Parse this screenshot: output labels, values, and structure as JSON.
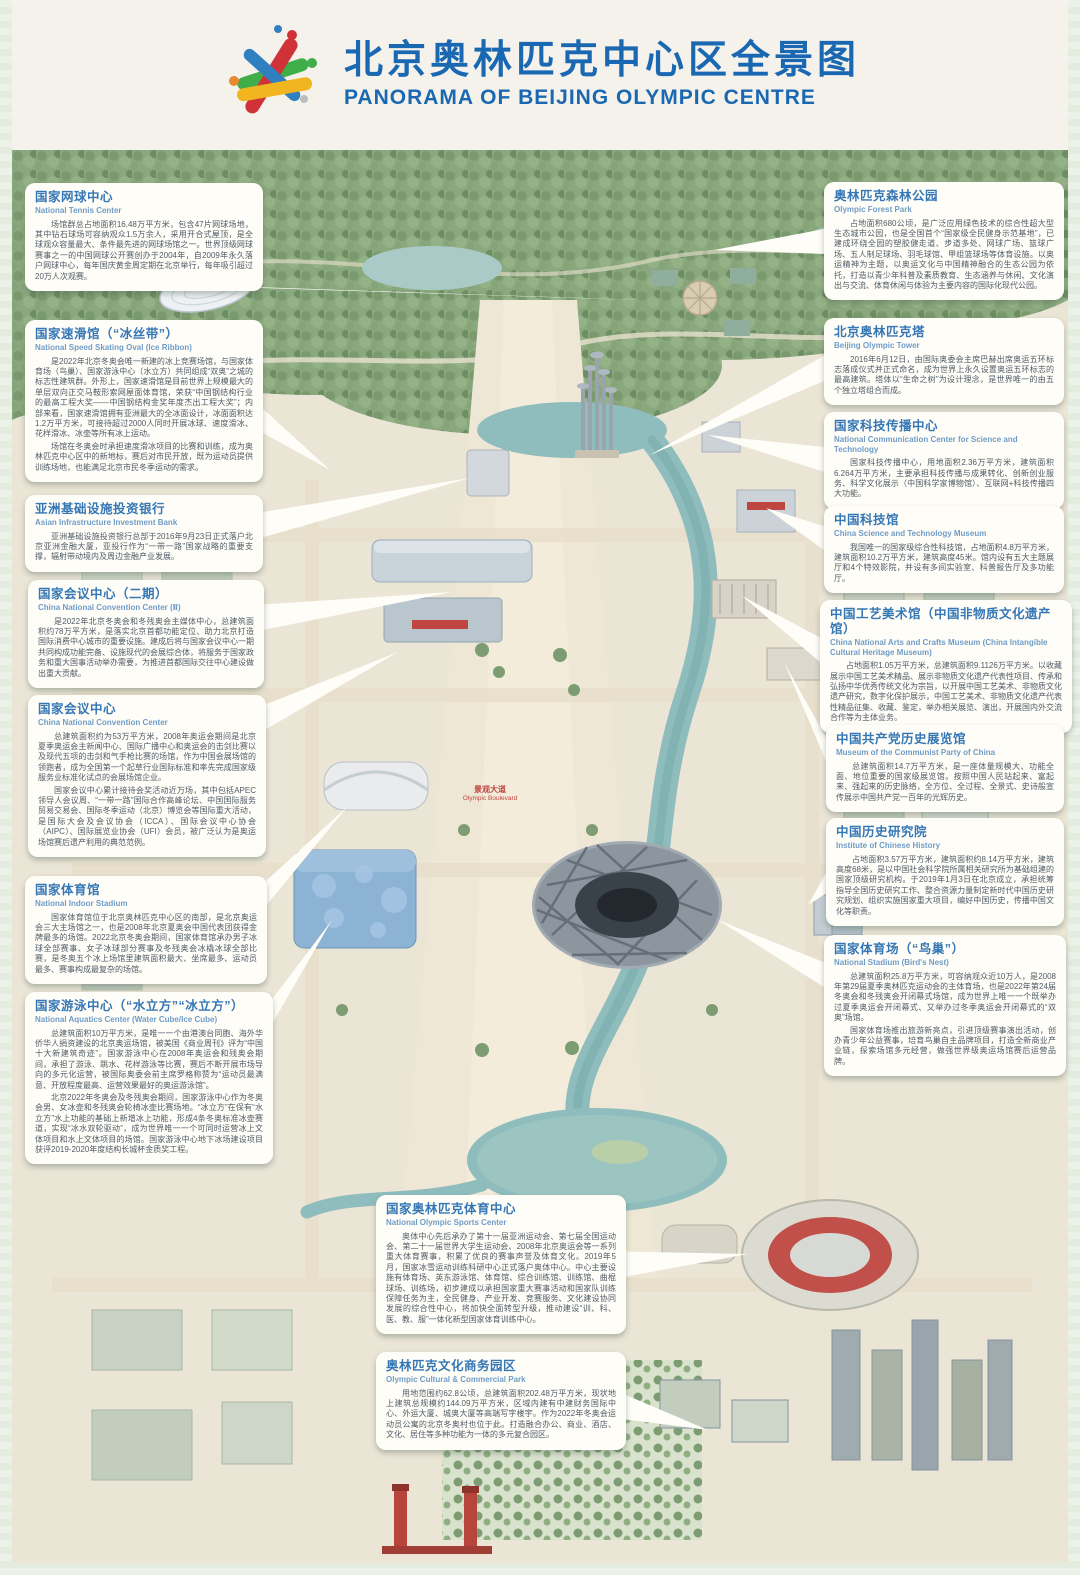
{
  "header": {
    "title_zh": "北京奥林匹克中心区全景图",
    "title_en": "PANORAMA OF BEIJING OLYMPIC CENTRE"
  },
  "colors": {
    "title_blue": "#1a68b2",
    "callout_title_blue": "#3577b5",
    "body_text": "#4f5b66",
    "leader_white": "#fffdf8",
    "river_teal": "#8fbdbd",
    "forest_green": "#8aa87e",
    "sign_red": "#bf4540"
  },
  "map": {
    "boulevard_label_zh": "景观大道",
    "boulevard_label_en": "Olympic Boulevard"
  },
  "callouts": [
    {
      "id": "national-tennis-center",
      "title_zh": "国家网球中心",
      "title_en": "National Tennis Center",
      "body": [
        "场馆群总占地面积16.48万平方米，包含47片网球场地，其中钻石球场可容纳观众1.5万余人，采用开合式屋顶，是全球观众容量最大、条件最先进的网球场馆之一。世界顶级网球赛事之一的中国网球公开赛创办于2004年，自2009年永久落户网球中心，每年国庆黄金周定期在北京举行，每年吸引超过20万人次观赛。"
      ],
      "pos": {
        "left": 25,
        "top": 183,
        "width": 238
      },
      "tail": {
        "side": "bottom",
        "f": 0.78,
        "tx": 700,
        "ty": 302
      }
    },
    {
      "id": "national-speed-skating-oval",
      "title_zh": "国家速滑馆（“冰丝带”）",
      "title_en": "National Speed Skating Oval (Ice Ribbon)",
      "body": [
        "是2022年北京冬奥会唯一新建的冰上竞赛场馆，与国家体育场（鸟巢）、国家游泳中心（水立方）共同组成“双奥”之城的标志性建筑群。外形上，国家速滑馆是目前世界上规模最大的单层双向正交马鞍形索网屋面体育馆，荣获“中国钢结构行业的最高工程大奖——中国钢结构金奖年度杰出工程大奖”；内部来看，国家速滑馆拥有亚洲最大的全冰面设计，冰面面积达1.2万平方米，可接待超过2000人同时开展冰球、速度滑冰、花样滑冰、冰壶等所有冰上运动。",
        "场馆在冬奥会时承担速度滑冰项目的比赛和训练，成为奥林匹克中心区中的新地标，赛后对市民开放，既为运动员提供训练场地，也能满足北京市民冬季运动的需求。"
      ],
      "pos": {
        "left": 25,
        "top": 320,
        "width": 238
      },
      "tail": {
        "side": "right",
        "f": 0.6,
        "tx": 330,
        "ty": 470
      }
    },
    {
      "id": "asian-infrastructure-investment-bank",
      "title_zh": "亚洲基础设施投资银行",
      "title_en": "Asian Infrastructure Investment Bank",
      "body": [
        "亚洲基础设施投资银行总部于2016年9月23日正式落户北京亚洲金融大厦，亚投行作为“一带一路”国家战略的重要支撑，辐射带动境内及周边金融产业发展。"
      ],
      "pos": {
        "left": 25,
        "top": 495,
        "width": 238
      },
      "tail": {
        "side": "right",
        "f": 0.4,
        "tx": 470,
        "ty": 478
      }
    },
    {
      "id": "china-national-convention-center-2",
      "title_zh": "国家会议中心（二期）",
      "title_en": "China National Convention Center (Ⅱ)",
      "body": [
        "是2022年北京冬奥会和冬残奥会主媒体中心，总建筑面积约78万平方米，是落实北京首都功能定位、助力北京打造国际消费中心城市的重要设施。建成后将与国家会议中心一期共同构成功能完备、设施现代的会展综合体，将服务于国家政务和重大国事活动举办需要，为推进首都国际交往中心建设做出重大贡献。"
      ],
      "pos": {
        "left": 28,
        "top": 580,
        "width": 236
      },
      "tail": {
        "side": "right",
        "f": 0.35,
        "tx": 452,
        "ty": 592
      }
    },
    {
      "id": "china-national-convention-center",
      "title_zh": "国家会议中心",
      "title_en": "China National Convention Center",
      "body": [
        "总建筑面积约为53万平方米，2008年奥运会期间是北京夏季奥运会主新闻中心、国际广播中心和奥运会的击剑比赛以及现代五项的击剑和气手枪比赛的场馆，作为中国会展场馆的领跑者，成为全国第一个起草行业国际标准和率先完成国家级服务业标准化试点的会展场馆企业。",
        "国家会议中心累计接待会奖活动近万场，其中包括APEC领导人会议周、“一带一路”国际合作高峰论坛、中国国际服务贸易交易会、国际冬季运动（北京）博览会等国际重大活动，是国际大会及会议协会（ICCA）、国际会议中心协会（AIPC）、国际展览业协会（UFI）会员，被广泛认为是奥运场馆赛后遗产利用的典范范例。"
      ],
      "pos": {
        "left": 28,
        "top": 695,
        "width": 238
      },
      "tail": {
        "side": "right",
        "f": 0.15,
        "tx": 398,
        "ty": 652
      }
    },
    {
      "id": "national-indoor-stadium",
      "title_zh": "国家体育馆",
      "title_en": "National Indoor Stadium",
      "body": [
        "国家体育馆位于北京奥林匹克中心区的南部，是北京奥运会三大主场馆之一，也是2008年北京夏奥会中国代表团获得金牌最多的场馆。2022北京冬奥会期间，国家体育馆承办男子冰球全部赛事、女子冰球部分赛事及冬残奥会冰橇冰球全部比赛，是冬奥五个冰上场馆里建筑面积最大、坐席最多、运动员最多、赛事构成最复杂的场馆。"
      ],
      "pos": {
        "left": 25,
        "top": 876,
        "width": 242
      },
      "tail": {
        "side": "right",
        "f": 0.2,
        "tx": 348,
        "ty": 806
      }
    },
    {
      "id": "national-aquatics-center",
      "title_zh": "国家游泳中心（“水立方”“冰立方”）",
      "title_en": "National Aquatics Center (Water Cube/Ice Cube)",
      "body": [
        "总建筑面积10万平方米，是唯一一个由港澳台同胞、海外华侨华人捐资建设的北京奥运场馆，被美国《商业周刊》评为“中国十大新建筑奇迹”。国家游泳中心在2008年奥运会和残奥会期间，承担了游泳、跳水、花样游泳等比赛，赛后不断开展市场导向的多元化运营，被国际奥委会前主席罗格称赞为“运动员最满意、开放程度最高、运营效果最好的奥运游泳馆”。",
        "北京2022年冬奥会及冬残奥会期间，国家游泳中心作为冬奥会男、女冰壶和冬残奥会轮椅冰壶比赛场地。“冰立方”在保有“水立方”水上功能的基础上新增冰上功能，形成4条冬奥标准冰壶赛道，实现“冰水双轮驱动”，成为世界唯一一个可同时运营冰上文体项目和水上文体项目的场馆。国家游泳中心地下冰场建设项目获评2019-2020年度结构长城杯金质奖工程。"
      ],
      "pos": {
        "left": 25,
        "top": 992,
        "width": 248
      },
      "tail": {
        "side": "right",
        "f": 0.15,
        "tx": 332,
        "ty": 920
      }
    },
    {
      "id": "olympic-forest-park",
      "title_zh": "奥林匹克森林公园",
      "title_en": "Olympic Forest Park",
      "body": [
        "占地面积680公顷，是广泛应用绿色技术的综合性超大型生态城市公园，也是全国首个“国家级全民健身示范基地”，已建成环绕全园的塑胶健走道、步道多处、网球广场、篮球广场、五人制足球场、羽毛球馆、甲组篮球场等体育设施。以奥运精神为主题，以奥运文化与中国精神融合的生态公园为依托，打造以青少年科普及素质教育、生态涵养与休闲、文化演出与交流、体育休闲与体验为主要内容的国际化现代公园。"
      ],
      "pos": {
        "left": 824,
        "top": 182,
        "width": 240
      },
      "tail": {
        "side": "left",
        "f": 0.5,
        "tx": 714,
        "ty": 250
      }
    },
    {
      "id": "beijing-olympic-tower",
      "title_zh": "北京奥林匹克塔",
      "title_en": "Beijing Olympic Tower",
      "body": [
        "2016年6月12日，由国际奥委会主席巴赫出席奥运五环标志落成仪式并正式命名，成为世界上永久设置奥运五环标志的最高建筑。塔体以“生命之树”为设计理念，是世界唯一的由五个独立塔组合而成。"
      ],
      "pos": {
        "left": 824,
        "top": 318,
        "width": 240
      },
      "tail": {
        "side": "left",
        "f": 0.55,
        "tx": 650,
        "ty": 455
      }
    },
    {
      "id": "national-communication-center-for-science-and-technology",
      "title_zh": "国家科技传播中心",
      "title_en": "National Communication Center for Science and Technology",
      "body": [
        "国家科技传播中心，用地面积2.36万平方米，建筑面积6.264万平方米，主要承担科技传播与成果转化、创新创业服务、科学文化展示（中国科学家博物馆）、互联网+科技传播四大功能。"
      ],
      "pos": {
        "left": 824,
        "top": 412,
        "width": 240
      },
      "tail": {
        "side": "left",
        "f": 0.5,
        "tx": 708,
        "ty": 435
      }
    },
    {
      "id": "china-science-and-technology-museum",
      "title_zh": "中国科技馆",
      "title_en": "China Science and Technology Museum",
      "body": [
        "我国唯一的国家级综合性科技馆，占地面积4.8万平方米，建筑面积10.2万平方米，建筑高度45米。馆内设有五大主题展厅和4个特效影院，并设有多间实验室、科普报告厅及多功能厅。"
      ],
      "pos": {
        "left": 824,
        "top": 506,
        "width": 240
      },
      "tail": {
        "side": "left",
        "f": 0.4,
        "tx": 766,
        "ty": 508
      }
    },
    {
      "id": "china-national-arts-and-crafts-museum",
      "title_zh": "中国工艺美术馆（中国非物质文化遗产馆）",
      "title_en": "China National Arts and Crafts Museum (China Intangible Cultural Heritage Museum)",
      "body": [
        "占地面积1.05万平方米，总建筑面积9.1126万平方米。以收藏展示中国工艺美术精品、展示非物质文化遗产代表性项目、传承和弘扬中华优秀传统文化为宗旨，以开展中国工艺美术、非物质文化遗产研究，数字化保护展示，中国工艺美术、非物质文化遗产代表性精品征集、收藏、鉴定，举办相关展览、演出，开展国内外交流合作等为主体业务。"
      ],
      "pos": {
        "left": 820,
        "top": 600,
        "width": 252
      },
      "tail": {
        "side": "left",
        "f": 0.4,
        "tx": 742,
        "ty": 596
      }
    },
    {
      "id": "museum-of-the-communist-party-of-china",
      "title_zh": "中国共产党历史展览馆",
      "title_en": "Museum of  the Communist Party of China",
      "body": [
        "总建筑面积14.7万平方米，是一座体量规模大、功能全面、地位重要的国家级展览馆。按照中国人民站起来、富起来、强起来的历史脉络，全方位、全过程、全景式、史诗般宣传展示中国共产党一百年的光辉历史。"
      ],
      "pos": {
        "left": 826,
        "top": 725,
        "width": 238
      },
      "tail": {
        "side": "left",
        "f": 0.4,
        "tx": 784,
        "ty": 662
      }
    },
    {
      "id": "institute-of-chinese-history",
      "title_zh": "中国历史研究院",
      "title_en": "Institute of Chinese History",
      "body": [
        "占地面积3.57万平方米，建筑面积约8.14万平方米，建筑高度68米，是以中国社会科学院所属相关研究所为基础组建的国家顶级研究机构。于2019年1月3日在北京成立，承担统筹指导全国历史研究工作、整合资源力量制定新时代中国历史研究规划、组织实施国家重大项目，编好中国历史，传播中国文化等职责。"
      ],
      "pos": {
        "left": 826,
        "top": 818,
        "width": 238
      },
      "tail": {
        "side": "left",
        "f": 0.55,
        "tx": 808,
        "ty": 905
      }
    },
    {
      "id": "national-stadium-birds-nest",
      "title_zh": "国家体育场（“鸟巢”）",
      "title_en": "National Stadium (Bird's Nest)",
      "body": [
        "总建筑面积25.8万平方米，可容纳观众近10万人，是2008年第29届夏季奥林匹克运动会的主体育场，也是2022年第24届冬奥会和冬残奥会开闭幕式场馆，成为世界上唯一一个既举办过夏季奥运会开闭幕式、又举办过冬季奥运会开闭幕式的“双奥”场馆。",
        "国家体育场推出旅游新亮点，引进顶级赛事演出活动，创办青少年公益赛事，培育鸟巢自主品牌项目，打造全新商业产业链，探索场馆多元经营，做强世界级奥运场馆赛后运营品牌。"
      ],
      "pos": {
        "left": 824,
        "top": 935,
        "width": 242
      },
      "tail": {
        "side": "left",
        "f": 0.3,
        "tx": 718,
        "ty": 920
      }
    },
    {
      "id": "national-olympic-sports-center",
      "title_zh": "国家奥林匹克体育中心",
      "title_en": "National Olympic Sports Center",
      "body": [
        "奥体中心先后承办了第十一届亚洲运动会、第七届全国运动会、第二十一届世界大学生运动会、2008年北京奥运会等一系列重大体育赛事，积累了优良的赛事声誉及体育文化。2019年5月，国家冰雪运动训练科研中心正式落户奥体中心。中心主要设施有体育场、英东游泳馆、体育馆、综合训练馆、训练馆、曲棍球场、训练场，初步建成以承担国家重大赛事活动和国家队训练保障任务为主，全民健身、产业开发、竞赛服务、文化建设协同发展的综合性中心，将加快全面转型升级，推动建设“训、科、医、教、服”一体化新型国家体育训练中心。"
      ],
      "pos": {
        "left": 376,
        "top": 1195,
        "width": 250
      },
      "tail": {
        "side": "right",
        "f": 0.5,
        "tx": 748,
        "ty": 1254
      }
    },
    {
      "id": "olympic-cultural-commercial-park",
      "title_zh": "奥林匹克文化商务园区",
      "title_en": "Olympic Cultural & Commercial Park",
      "body": [
        "用地范围约62.8公顷，总建筑面积202.48万平方米，现状地上建筑总规模约144.09万平方米，区域内建有中建财务国际中心、外运大厦、城奥大厦等高端写字楼宇。作为2022年冬奥会运动员公寓的北京冬奥村也位于此。打造融合办公、商业、酒店、文化、居住等多种功能为一体的多元复合园区。"
      ],
      "pos": {
        "left": 376,
        "top": 1352,
        "width": 250
      },
      "tail": {
        "side": "right",
        "f": 0.55,
        "tx": 708,
        "ty": 1430
      }
    }
  ]
}
